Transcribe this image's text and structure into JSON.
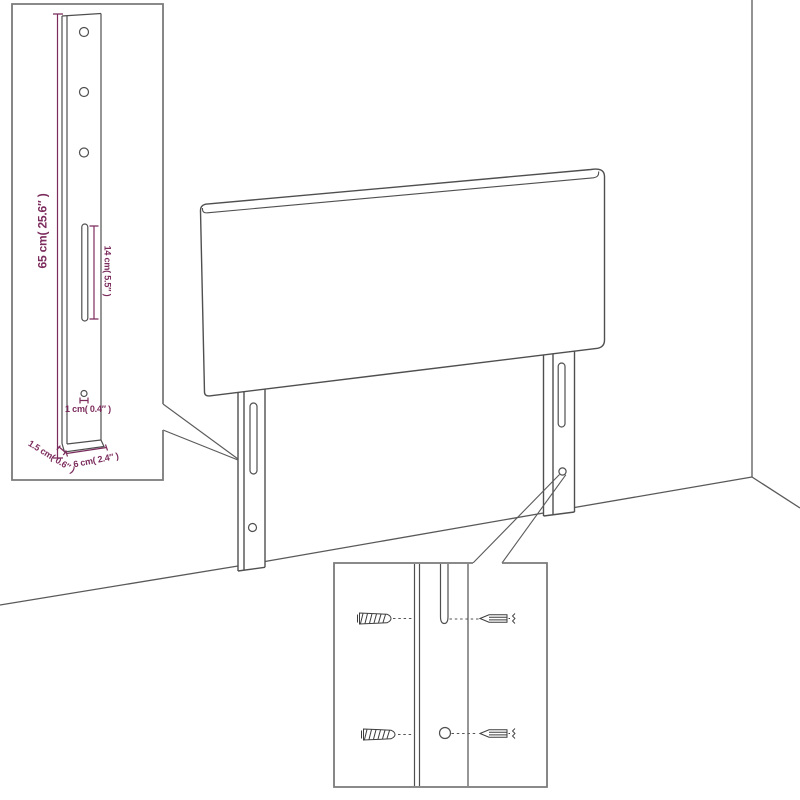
{
  "diagram": {
    "accent_color": "#7b2b5c",
    "line_color": "#4f4f4f",
    "border_color": "#7a7a7a"
  },
  "labels": {
    "leg_height": "65 cm( 25.6″ )",
    "slot_length": "14 cm( 5.5″ )",
    "hole_diameter": "1 cm( 0.4″ )",
    "leg_thickness": "1.5 cm( 0.6″ )",
    "leg_width": "6 cm( 2.4″ )"
  }
}
